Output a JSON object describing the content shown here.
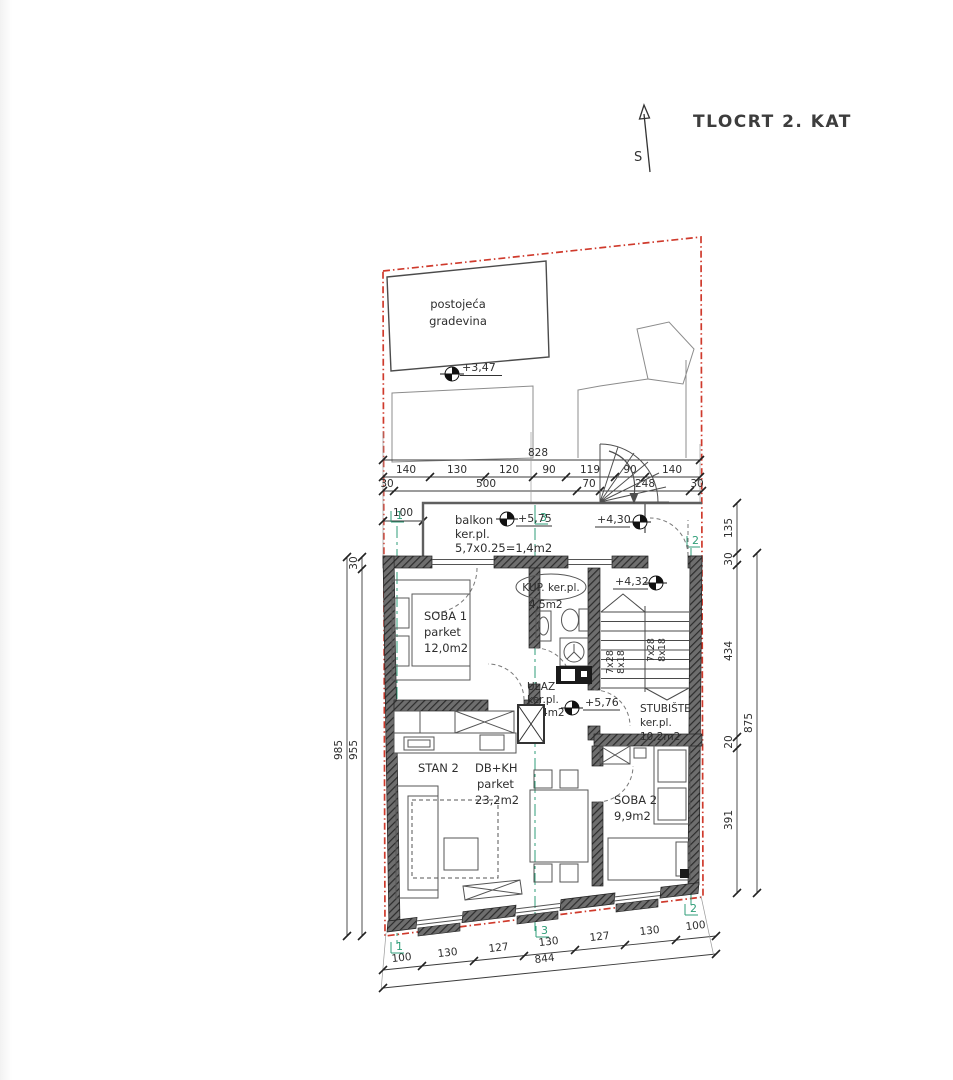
{
  "title": "TLOCRT 2. KAT",
  "north": {
    "label": "S"
  },
  "site": {
    "existing_line1": "postojeća",
    "existing_line2": "gradevina",
    "elev_existing": "+3,47"
  },
  "balcony": {
    "l1": "balkon",
    "l2": "ker.pl.",
    "l3": "5,7x0.25=1,4m2",
    "elev": "+5,75",
    "dim": "100"
  },
  "landing": {
    "elev": "+4,30"
  },
  "rooms": {
    "soba1": {
      "l1": "SOBA 1",
      "l2": "parket",
      "l3": "12,0m2"
    },
    "kup": {
      "l1": "KUP. ker.pl.",
      "l2": "4,5m2"
    },
    "ulaz": {
      "l1": "ULAZ",
      "l2": "ker.pl.",
      "l3": "3,4m2",
      "elev": "+5,76"
    },
    "stan2": {
      "l1": "STAN 2",
      "l2": "DB+KH",
      "l3": "parket",
      "l4": "23,2m2"
    },
    "soba2": {
      "l1": "SOBA 2",
      "l2": "9,9m2"
    },
    "stubiste": {
      "l1": "STUBIŠTE",
      "l2": "ker.pl.",
      "l3": "10,2m2",
      "elev": "+4,32",
      "run1": "7x28",
      "run2": "8x18"
    }
  },
  "dims": {
    "top_total": "828",
    "top_row2": [
      "140",
      "130",
      "120",
      "90",
      "119",
      "90",
      "140"
    ],
    "top_row3": [
      "30",
      "500",
      "70",
      "248",
      "30"
    ],
    "left": {
      "d30": "30",
      "d955": "955",
      "d985": "985"
    },
    "right": {
      "d135": "135",
      "d30": "30",
      "d434": "434",
      "d20": "20",
      "d391": "391",
      "d875": "875"
    },
    "bottom": [
      "100",
      "130",
      "127",
      "130",
      "127",
      "130",
      "100"
    ],
    "bottom_total": "844"
  },
  "sections": {
    "s1": "1",
    "s2": "2",
    "s3": "3"
  },
  "colors": {
    "boundary": "#cf3a2c",
    "section": "#2f9e78",
    "wall": "#5a5a5a",
    "line": "#3a3a3a"
  }
}
